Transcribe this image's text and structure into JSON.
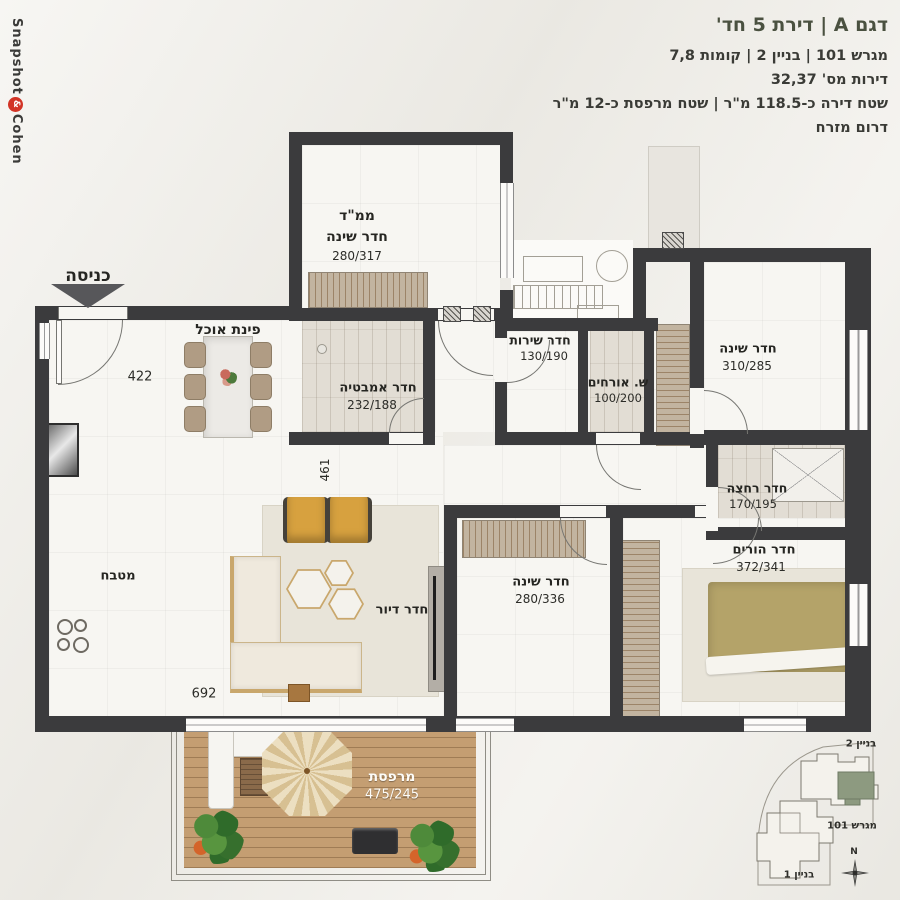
{
  "logo": {
    "word1": "Snapshot",
    "symbol": "&",
    "word2": "Cohen"
  },
  "header": {
    "title": "דגם A | דירת 5 חד'",
    "line_lot": "מגרש 101 | בניין 2 | קומות 7,8",
    "line_apartments": "דירות מס' 32,37",
    "line_area": "שטח דירה כ-118.5 מ\"ר | שטח מרפסת כ-12 מ\"ר",
    "line_direction": "דרום מזרח"
  },
  "entrance": {
    "label": "כניסה"
  },
  "rooms": [
    {
      "id": "mamad",
      "name": "ממ\"ד",
      "sub": "חדר שינה",
      "dims": "280/317"
    },
    {
      "id": "dining",
      "name": "פינת אוכל"
    },
    {
      "id": "bathroom",
      "name": "חדר אמבטיה",
      "dims": "232/188"
    },
    {
      "id": "service",
      "name": "חדר שירות",
      "dims": "130/190"
    },
    {
      "id": "guest-wc",
      "name": "ש. אורחים",
      "dims": "100/200"
    },
    {
      "id": "bedroom-right",
      "name": "חדר שינה",
      "dims": "310/285"
    },
    {
      "id": "washroom",
      "name": "חדר רחצה",
      "dims": "170/195"
    },
    {
      "id": "master-bedroom",
      "name": "חדר הורים",
      "dims": "372/341"
    },
    {
      "id": "bedroom-middle",
      "name": "חדר שינה",
      "dims": "280/336"
    },
    {
      "id": "living-room",
      "name": "חדר דיור"
    },
    {
      "id": "kitchen",
      "name": "מטבח"
    },
    {
      "id": "balcony",
      "name": "מרפסת",
      "dims": "475/245"
    }
  ],
  "dimensions": {
    "entry_width": "422",
    "hall_depth": "461",
    "living_width": "692"
  },
  "siteplan": {
    "building_top": "בניין 2",
    "lot": "מגרש 101",
    "building_bottom": "בניין 1",
    "north": "N",
    "highlight_color": "#8d9a80"
  },
  "colors": {
    "accent_title": "#4a5140",
    "wall": "#3b3b3d",
    "logo_red": "#d23426",
    "wood_deck": "#c49e72",
    "green_chair": "#3f5440",
    "olive_duvet": "#b4a369"
  }
}
